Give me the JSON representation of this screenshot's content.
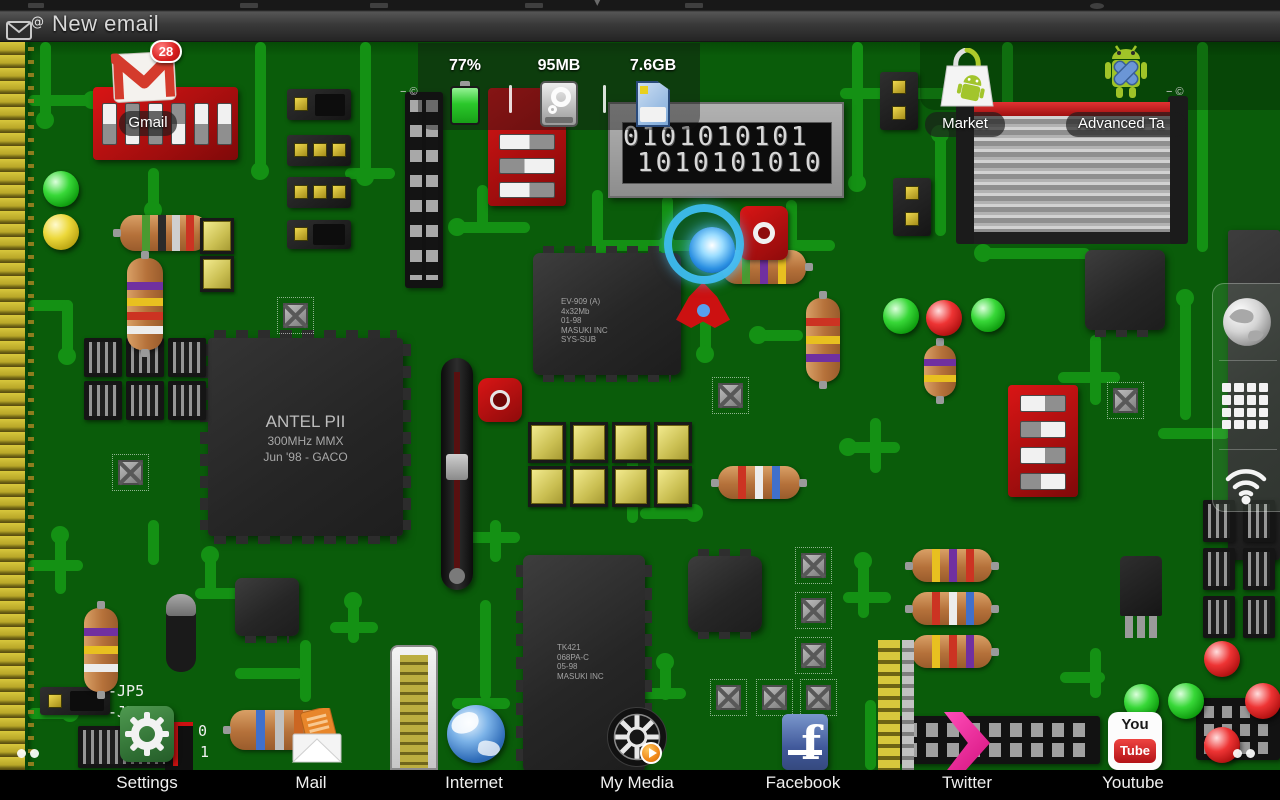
{
  "status_bar": {
    "notification_text": "New email"
  },
  "widget": {
    "battery_percent": "77%",
    "memory": "95MB",
    "storage": "7.6GB"
  },
  "shortcuts": {
    "gmail": {
      "label": "Gmail",
      "badge": "28"
    },
    "market": {
      "label": "Market"
    },
    "advanced_task": {
      "label": "Advanced Ta"
    }
  },
  "sidebar": {
    "icons": [
      "browser-globe",
      "app-drawer",
      "wifi"
    ]
  },
  "dock": {
    "items": [
      {
        "label": "Settings"
      },
      {
        "label": "Mail"
      },
      {
        "label": "Internet"
      },
      {
        "label": "My Media"
      },
      {
        "label": "Facebook",
        "icon_letter": "f"
      },
      {
        "label": "Twitter"
      },
      {
        "label": "Youtube",
        "icon_top": "You",
        "icon_bottom": "Tube"
      }
    ]
  },
  "wallpaper": {
    "cpu_chip": {
      "line1": "ANTEL PII",
      "line2": "300MHz MMX",
      "line3": "Jun '98 - GACO"
    },
    "ram_chip": {
      "line1": "EV-909 (A)",
      "line2": "4x32Mb",
      "line3": "01-98",
      "line4": "MASUKI INC",
      "line5": "SYS-SUB"
    },
    "tk_chip": {
      "line1": "TK421",
      "line2": "068PA-C",
      "line3": "05-98",
      "line4": "MASUKI INC"
    },
    "binary_row1": "0101010101",
    "binary_row2": "1010101010",
    "jumper_labels": {
      "jp5": "-JP5",
      "jp6": "-JP6",
      "zero": "0",
      "one": "1"
    },
    "silkscreen": "−  ©"
  },
  "colors": {
    "board": "#0a5c0a",
    "trace": "#149114",
    "dip_red": "#c01010",
    "magenta": "#e8189b"
  }
}
